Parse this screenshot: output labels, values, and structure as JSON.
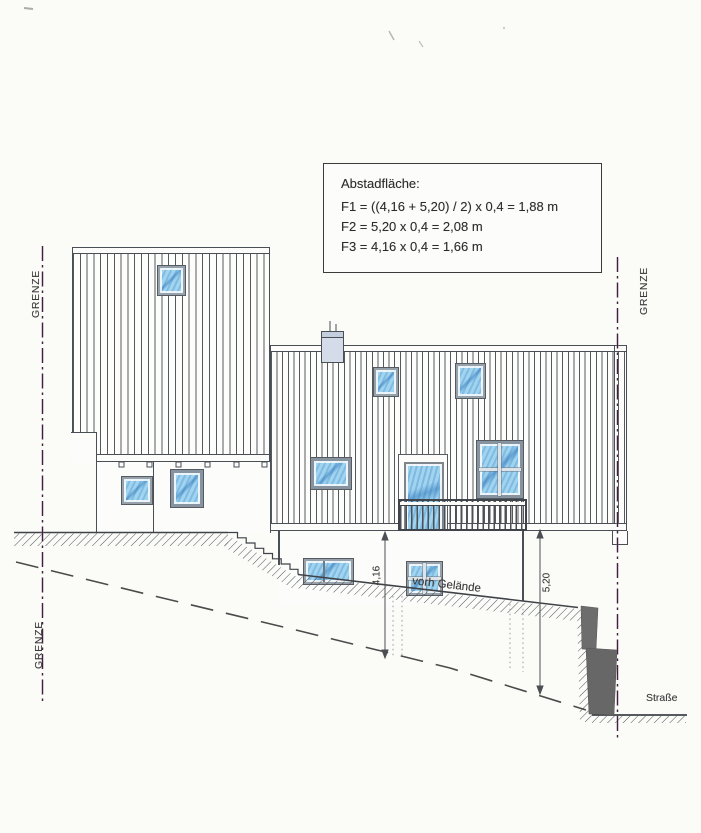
{
  "annotation_box": {
    "title": "Abstadfläche:",
    "formula_1": "F1 = ((4,16 + 5,20) / 2) x 0,4 = 1,88 m",
    "formula_2": "F2 = 5,20 x 0,4 = 2,08 m",
    "formula_3": "F3 = 4,16 x 0,4 = 1,66 m"
  },
  "labels": {
    "boundary_left_upper": "GRENZE",
    "boundary_left_lower": "GRENZE",
    "boundary_right": "GRENZE",
    "existing_terrain": "vorh Gelände",
    "street": "Straße",
    "dimension_left": "4,16",
    "dimension_right": "5,20"
  },
  "colors": {
    "paper": "#fbfbf8",
    "line_dark": "#4a4f55",
    "window_blue": "#9fd3ef",
    "window_blue_dark": "#4f9fd0",
    "chimney_gray": "#d3dce8",
    "retaining_wall_gray": "#6d6d6d",
    "boundary_magenta": "#b565a5"
  }
}
